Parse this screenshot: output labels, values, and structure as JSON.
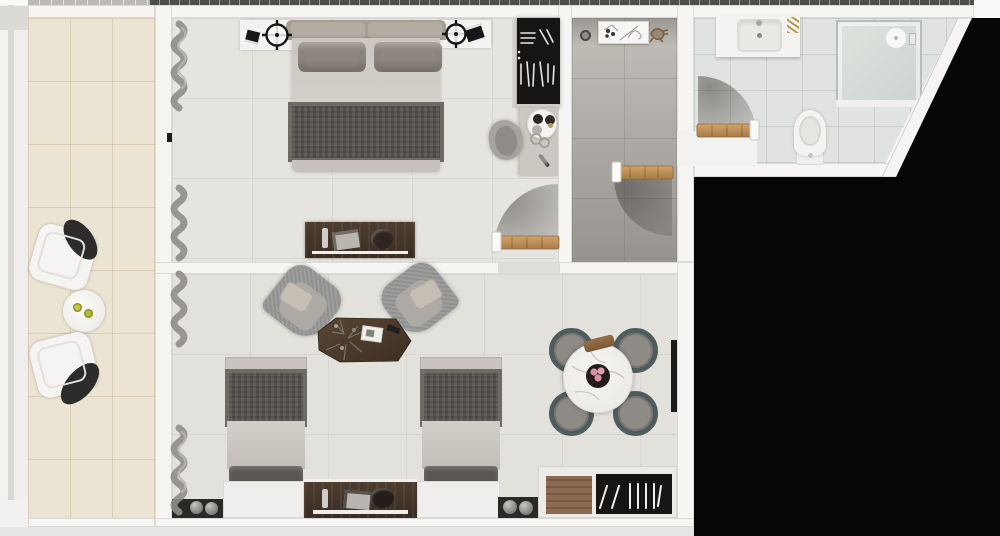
{
  "image_type": "3d-rendered-apartment-floorplan-top-view",
  "palette": {
    "page": "#fafaf9",
    "outside": "#060606",
    "wall": "#f6f5f3",
    "wallEdge": "#cfccc8",
    "tickDark": "#504e4b",
    "tickLight": "#bdbab6",
    "balconyFloor": "#ece4d3",
    "balconyGrid": "rgba(186,166,132,0.35)",
    "bedroomFloor": "#e6e4df",
    "livingFloor": "#e3e1dc",
    "floorGrid": "rgba(178,174,166,0.22)",
    "hallTop": "#c3bfb9",
    "hallBottom": "#97948f",
    "bathFloor": "#e1e3e1",
    "bathGrid": "rgba(168,174,168,0.38)",
    "white": "#f3f2f0",
    "woodDark": "#4e3e31",
    "woodDark2": "#3a2d22",
    "doorWood": "#c99a62",
    "doorWood2": "#a87c48",
    "closetWood": "#8a6b52",
    "unitBlack": "#161514",
    "duvet": "#d2cfc9",
    "pillow": "#8e877e",
    "headboard": "#a59e95",
    "runner": "#54514d",
    "runnerEdge": "#6e6a64",
    "footBand": "#c6c2bb",
    "darkPillow": "#5a5751",
    "bedTopBand": "#c9c5be",
    "tweedA": "#909090",
    "tweedB": "#9e9e9c",
    "armPillow": "#c5beb4",
    "seatIn": "#adaaa5",
    "chairGray": "#a7a4a0",
    "mat": "#2b2927",
    "teal": "#4f5c5e",
    "seatGray": "#8e8b86",
    "marbleA": "#f6f4f1",
    "marbleB": "#e9e7e2",
    "vein": "#c3c0ba",
    "bowl": "#221b18",
    "pink": "#d793a1",
    "board": "#8a6443",
    "curtain": "#8f8d89",
    "curtainHi": "#bab8b4",
    "shade": "#565350",
    "porcelain": "#f4f3f1",
    "basin": "#eae8e5",
    "glassA": "#dfe4df",
    "glassB": "#ccd3ce",
    "glassEdge": "#b8beba",
    "gold": "#b99b4f",
    "sphereA": "#c7c5c2",
    "sphereB": "#6e6c6a",
    "lemonA": "#c6c73f",
    "lemonB": "#b5b837",
    "chairBack": "#2d2c2a",
    "lamp": "#161514"
  },
  "scene": {
    "balcony": {
      "items": [
        "patio-chair",
        "patio-chair",
        "round-side-table",
        "two-drinks"
      ]
    },
    "bedroom": {
      "items": [
        "double-bed",
        "headboard-cushions",
        "pillows",
        "bed-runner",
        "nightstand",
        "nightstand",
        "crosshair-table-lamp",
        "crosshair-table-lamp",
        "book",
        "book",
        "open-wardrobe-with-hangers",
        "desk",
        "desk-chair",
        "serving-tray-with-cups",
        "pen",
        "media-console",
        "remote",
        "magazine",
        "decor-bowl",
        "interior-door-with-swing",
        "window-curtains"
      ]
    },
    "hallway": {
      "items": [
        "wall-shelf-with-sketch-art",
        "peephole-detail",
        "coat-hook",
        "entry-door-with-swing"
      ]
    },
    "bathroom": {
      "items": [
        "vanity-counter",
        "rectangular-basin",
        "faucet",
        "gold-accessory",
        "walk-in-shower",
        "shower-head",
        "toilet",
        "door-with-swing",
        "angled-exterior-wall"
      ]
    },
    "living_room": {
      "items": [
        "armchair",
        "armchair",
        "organic-coffee-table",
        "plant-decor",
        "magazine",
        "remote",
        "twin-bed",
        "twin-bed",
        "headboard-panel",
        "headboard-panel",
        "media-console",
        "soundbar",
        "decor-spheres",
        "decor-spheres",
        "open-closet-with-hangers",
        "wall-panel",
        "round-marble-dining-table",
        "fruit-bowl",
        "serving-board",
        "dining-chair",
        "dining-chair",
        "dining-chair",
        "dining-chair",
        "window-curtains"
      ]
    }
  }
}
